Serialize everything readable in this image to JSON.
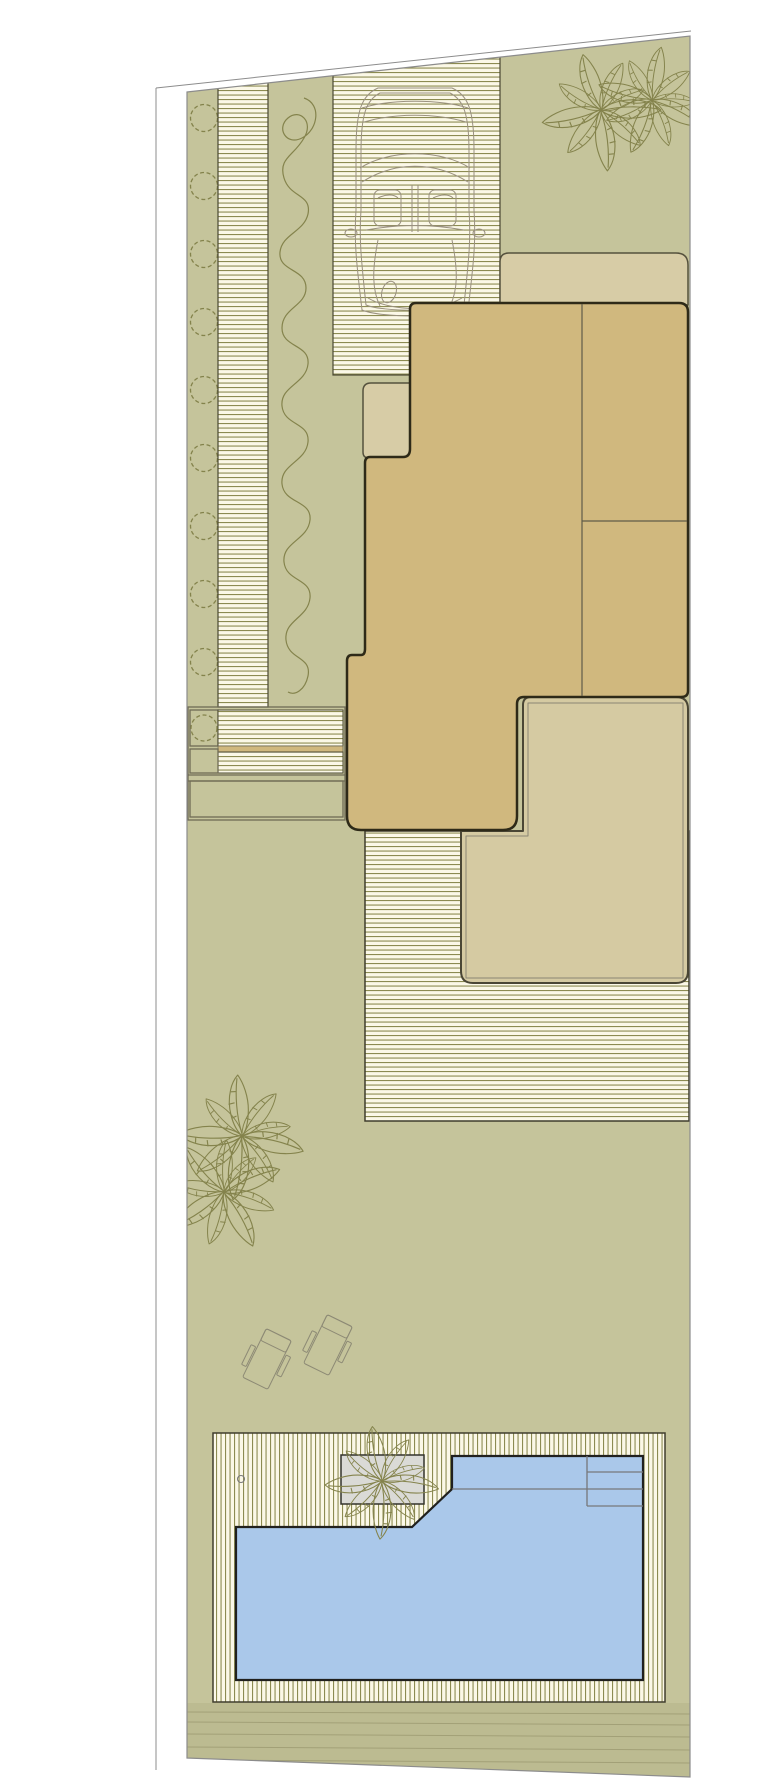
{
  "document": {
    "kind": "residential landscape site plan",
    "orientation": "portrait",
    "has_text": false
  },
  "palette": {
    "paper": "#ffffff",
    "lawn": "#c5c49b",
    "stripe_bg": "#fbf8e7",
    "stripe_line": "#8c8b51",
    "strip_edge": "#4a4833",
    "deck_edge": "#3f3d2c",
    "building_fill": "#d0b87e",
    "building_outline": "#2e2a18",
    "roof_fill": "#d7cca6",
    "roof_outline": "#55513d",
    "terrace_fill": "#d5caa2",
    "terrace_outline": "#4a4635",
    "terrace_inner": "#8b8774",
    "interior_line": "#5f5b49",
    "water": "#aac8ea",
    "pool_outline": "#20201e",
    "pool_detail": "#77777a",
    "planter_fill": "#dadad6",
    "planter_outline": "#33322b",
    "plant_stroke": "#84834c",
    "car_stroke": "#9a9180",
    "furniture_stroke": "#8d8a75",
    "frame_line": "#6f6b55",
    "verge_fill": "#bcbb91",
    "verge_line": "#9e9c73",
    "boundary_line": "#8c8c8c"
  },
  "elements": [
    {
      "name": "plot-boundary",
      "note": "trapezoidal parcel with slanted top and bottom edges, outer survey line on left"
    },
    {
      "name": "hedge-strip",
      "note": "left planting bed with row of dashed shrub circles"
    },
    {
      "name": "walkway-deck",
      "note": "narrow horizontally striped side path"
    },
    {
      "name": "vine-bed",
      "note": "planting strip with climbing-vine scribble symbol"
    },
    {
      "name": "driveway",
      "note": "striped drive with car outline symbol"
    },
    {
      "name": "palm-grove-top",
      "note": "two overlapping palm symbols at top right lawn"
    },
    {
      "name": "building-roof",
      "note": "light tan roof / canopy band behind building"
    },
    {
      "name": "main-building",
      "note": "stepped dark-outlined house footprint with two interior divider lines"
    },
    {
      "name": "side-frame-planter",
      "note": "framed entry block with small beds, stripes and tan band"
    },
    {
      "name": "rear-deck",
      "note": "horizontally striped deck behind building"
    },
    {
      "name": "terrace",
      "note": "light tan L-shaped terrace with inner offset line"
    },
    {
      "name": "lawn-palms",
      "note": "two palm symbols on mid lawn"
    },
    {
      "name": "lounge-chairs",
      "note": "two rotated sun lounger outlines"
    },
    {
      "name": "pool-deck",
      "note": "vertically striped pool surround"
    },
    {
      "name": "swimming-pool",
      "note": "pool with chamfered corner, underwater bench line and three entry steps"
    },
    {
      "name": "pool-planter",
      "note": "gray planter box with palm symbol"
    },
    {
      "name": "verge-strip",
      "note": "bottom planted verge with horizontal course lines"
    }
  ]
}
